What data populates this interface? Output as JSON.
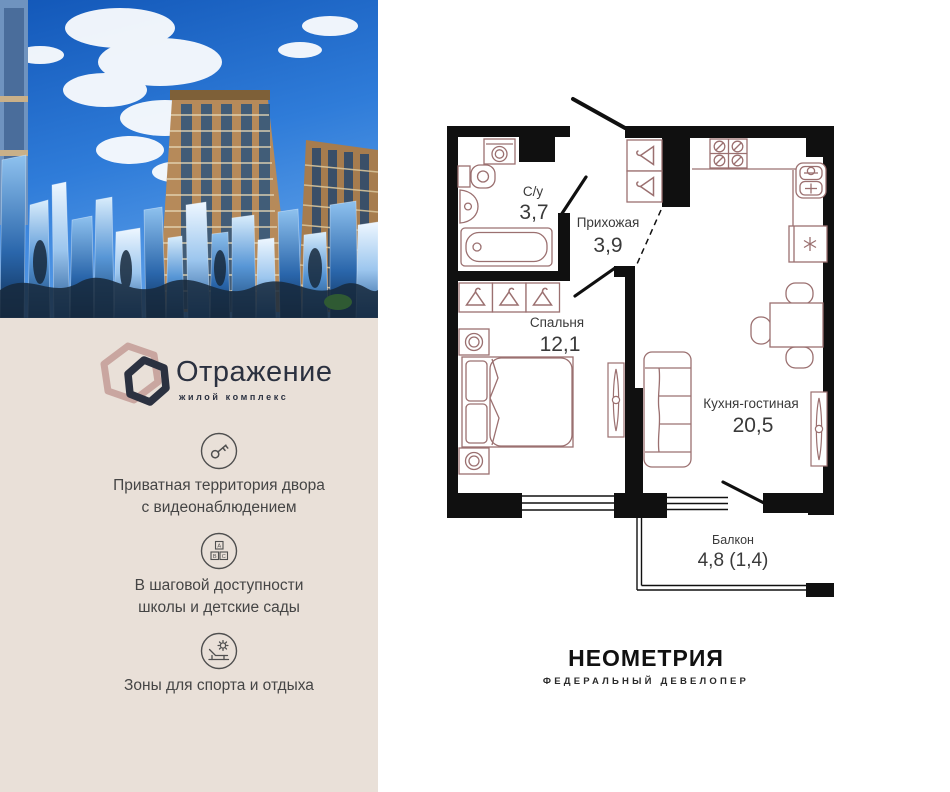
{
  "brand": {
    "name": "Отражение",
    "tagline": "жилой комплекс"
  },
  "features": [
    {
      "icon": "key-icon",
      "lines": [
        "Приватная территория двора",
        "с видеонаблюдением"
      ]
    },
    {
      "icon": "abc-blocks-icon",
      "lines": [
        "В шаговой доступности",
        "школы и детские сады"
      ]
    },
    {
      "icon": "lounge-sun-icon",
      "lines": [
        "Зоны для спорта и отдыха"
      ]
    }
  ],
  "floor_plan": {
    "rooms": [
      {
        "id": "bathroom",
        "name": "С/у",
        "area": "3,7"
      },
      {
        "id": "hallway",
        "name": "Прихожая",
        "area": "3,9"
      },
      {
        "id": "bedroom",
        "name": "Спальня",
        "area": "12,1"
      },
      {
        "id": "kitchen_living",
        "name": "Кухня-гостиная",
        "area": "20,5"
      },
      {
        "id": "balcony",
        "name": "Балкон",
        "area": "4,8 (1,4)"
      }
    ]
  },
  "developer": {
    "name": "НЕОМЕТРИЯ",
    "tagline": "ФЕДЕРАЛЬНЫЙ ДЕВЕЛОПЕР"
  },
  "colors": {
    "panel_beige": "#e9e0d8",
    "brand_navy": "#2b3140",
    "brand_rose": "#c5a09a",
    "wall_black": "#101010",
    "furniture_line": "#9b7070",
    "label_text": "#3a3a3a",
    "sky_blue": "#1f6bcd"
  }
}
